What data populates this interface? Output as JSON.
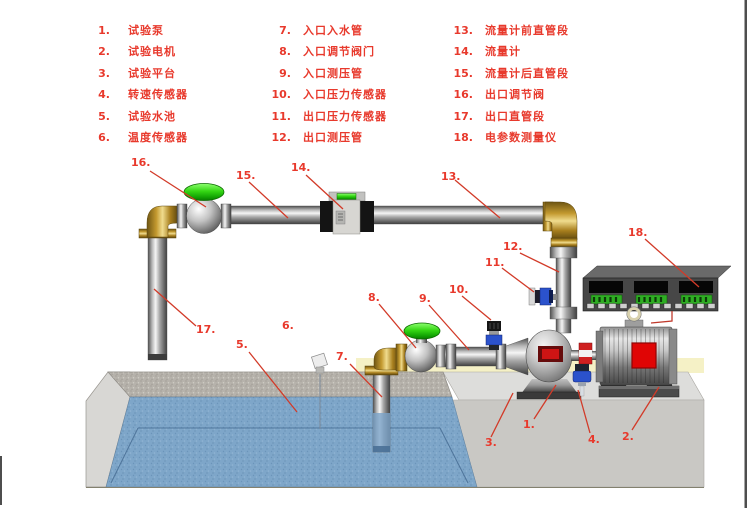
{
  "legend": {
    "items": [
      {
        "num": "1.",
        "label": "试验泵"
      },
      {
        "num": "2.",
        "label": "试验电机"
      },
      {
        "num": "3.",
        "label": "试验平台"
      },
      {
        "num": "4.",
        "label": "转速传感器"
      },
      {
        "num": "5.",
        "label": "试验水池"
      },
      {
        "num": "6.",
        "label": "温度传感器"
      },
      {
        "num": "7.",
        "label": "入口入水管"
      },
      {
        "num": "8.",
        "label": "入口调节阀门"
      },
      {
        "num": "9.",
        "label": "入口测压管"
      },
      {
        "num": "10.",
        "label": "入口压力传感器"
      },
      {
        "num": "11.",
        "label": "出口压力传感器"
      },
      {
        "num": "12.",
        "label": "出口测压管"
      },
      {
        "num": "13.",
        "label": "流量计前直管段"
      },
      {
        "num": "14.",
        "label": "流量计"
      },
      {
        "num": "15.",
        "label": "流量计后直管段"
      },
      {
        "num": "16.",
        "label": "出口调节阀"
      },
      {
        "num": "17.",
        "label": "出口直管段"
      },
      {
        "num": "18.",
        "label": "电参数测量仪"
      }
    ]
  },
  "callouts": {
    "c1": "1.",
    "c2": "2.",
    "c3": "3.",
    "c4": "4.",
    "c5": "5.",
    "c6": "6.",
    "c7": "7.",
    "c8": "8.",
    "c9": "9.",
    "c10": "10.",
    "c11": "11.",
    "c12": "12.",
    "c13": "13.",
    "c14": "14.",
    "c15": "15.",
    "c16": "16.",
    "c17": "17.",
    "c18": "18."
  },
  "colors": {
    "label_red": "#e8392c",
    "water_blue": "#7ea6c9",
    "valve_green": "#35d714",
    "brass": "#c3992f",
    "panel_green": "#2fae24"
  }
}
